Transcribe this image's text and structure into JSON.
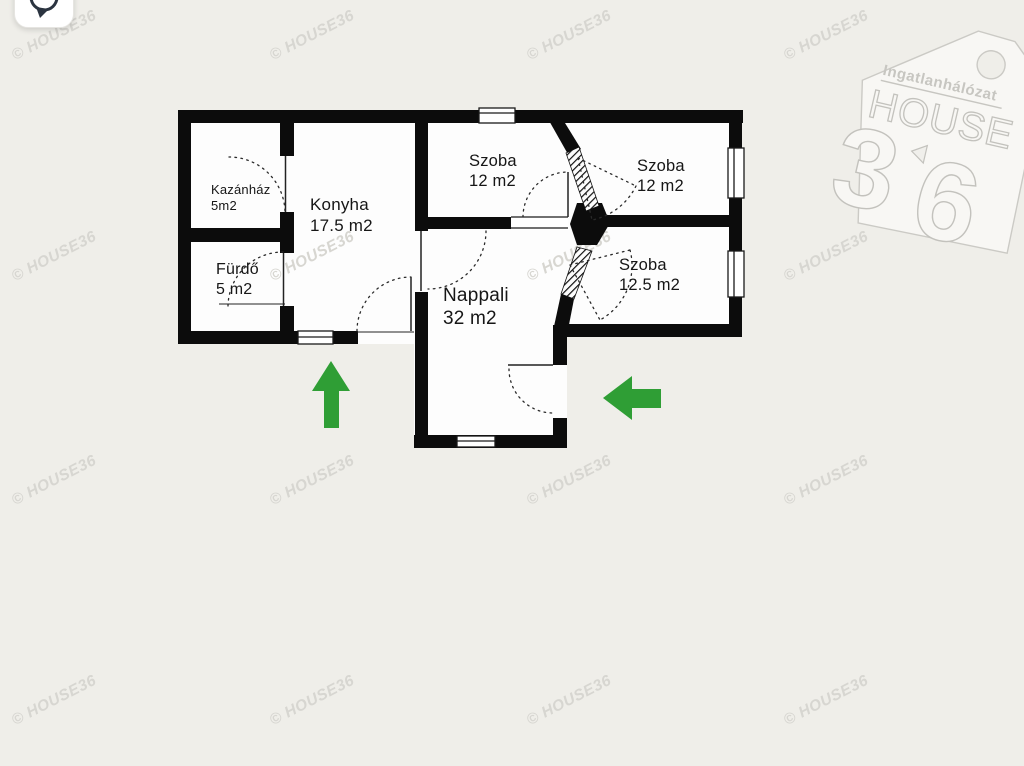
{
  "canvas": {
    "background_color": "#efeee9"
  },
  "toolbar": {
    "rotate_button_icon": "rotate-icon"
  },
  "watermark": {
    "text": "© HOUSE36",
    "color": "#d7d6d1"
  },
  "logo": {
    "network_label": "Ingatlanhálózat",
    "brand": "HOUSE",
    "digit_left": "3",
    "digit_right": "6"
  },
  "floor_plan": {
    "wall_color": "#0c0c0c",
    "floor_color": "#fdfdfd",
    "arrow_color": "#2f9e35",
    "rooms": [
      {
        "id": "kazanhaz",
        "name": "Kazánház",
        "area": "5m2"
      },
      {
        "id": "konyha",
        "name": "Konyha",
        "area": "17.5 m2"
      },
      {
        "id": "furdo",
        "name": "Fürdő",
        "area": "5 m2"
      },
      {
        "id": "szoba-top-left",
        "name": "Szoba",
        "area": "12 m2"
      },
      {
        "id": "szoba-top-right",
        "name": "Szoba",
        "area": "12 m2"
      },
      {
        "id": "szoba-right",
        "name": "Szoba",
        "area": "12.5 m2"
      },
      {
        "id": "nappali",
        "name": "Nappali",
        "area": "32 m2"
      }
    ],
    "arrows": [
      {
        "direction": "up"
      },
      {
        "direction": "left"
      }
    ]
  }
}
